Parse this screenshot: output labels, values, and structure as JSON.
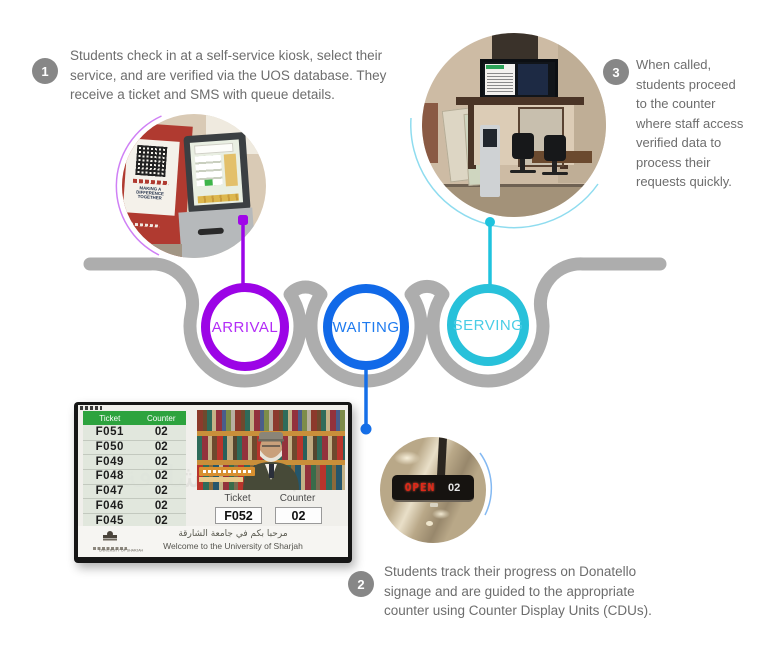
{
  "steps": {
    "step1": {
      "number": "1",
      "text": "Students check in at a self-service kiosk, select their\nservice, and are verified via the UOS database. They\nreceive a ticket and SMS with queue details."
    },
    "step2": {
      "number": "2",
      "text": "Students track their progress on Donatello\nsignage and are guided to the appropriate\ncounter using Counter Display Units (CDUs)."
    },
    "step3": {
      "number": "3",
      "text": "When called,\nstudents proceed\nto the counter\nwhere staff access\nverified data to\nprocess their\nrequests quickly."
    }
  },
  "stages": {
    "arrival": {
      "label": "ARRIVAL",
      "ring_color": "#9c04e6",
      "text_color": "#b32cf7"
    },
    "waiting": {
      "label": "WAITING",
      "ring_color": "#1169e8",
      "text_color": "#1f7bef"
    },
    "serving": {
      "label": "SERVING",
      "ring_color": "#28c1da",
      "text_color": "#49cde6"
    }
  },
  "signage": {
    "header": {
      "ticket": "Ticket",
      "counter": "Counter"
    },
    "rows": [
      {
        "ticket": "F051",
        "counter": "02"
      },
      {
        "ticket": "F050",
        "counter": "02"
      },
      {
        "ticket": "F049",
        "counter": "02"
      },
      {
        "ticket": "F048",
        "counter": "02"
      },
      {
        "ticket": "F047",
        "counter": "02"
      },
      {
        "ticket": "F046",
        "counter": "02"
      },
      {
        "ticket": "F045",
        "counter": "02"
      }
    ],
    "current": {
      "ticket_label": "Ticket",
      "ticket": "F052",
      "counter_label": "Counter",
      "counter": "02"
    },
    "welcome_ar": "مرحبا بكم في جامعة الشارقة",
    "welcome_en": "Welcome to the University of Sharjah",
    "logo_caption": "UNIVERSITY OF SHARJAH",
    "watermark": "جامعة الشارقة",
    "header_color": "#2da33e"
  },
  "cdu": {
    "open_label": "OPEN",
    "counter": "02",
    "led_color": "#e02818"
  },
  "kiosk_banner": {
    "line1": "MAKING A DIFFERENCE",
    "line2": "TOGETHER"
  },
  "wave_color": "#adadad",
  "badge_color": "#878787"
}
